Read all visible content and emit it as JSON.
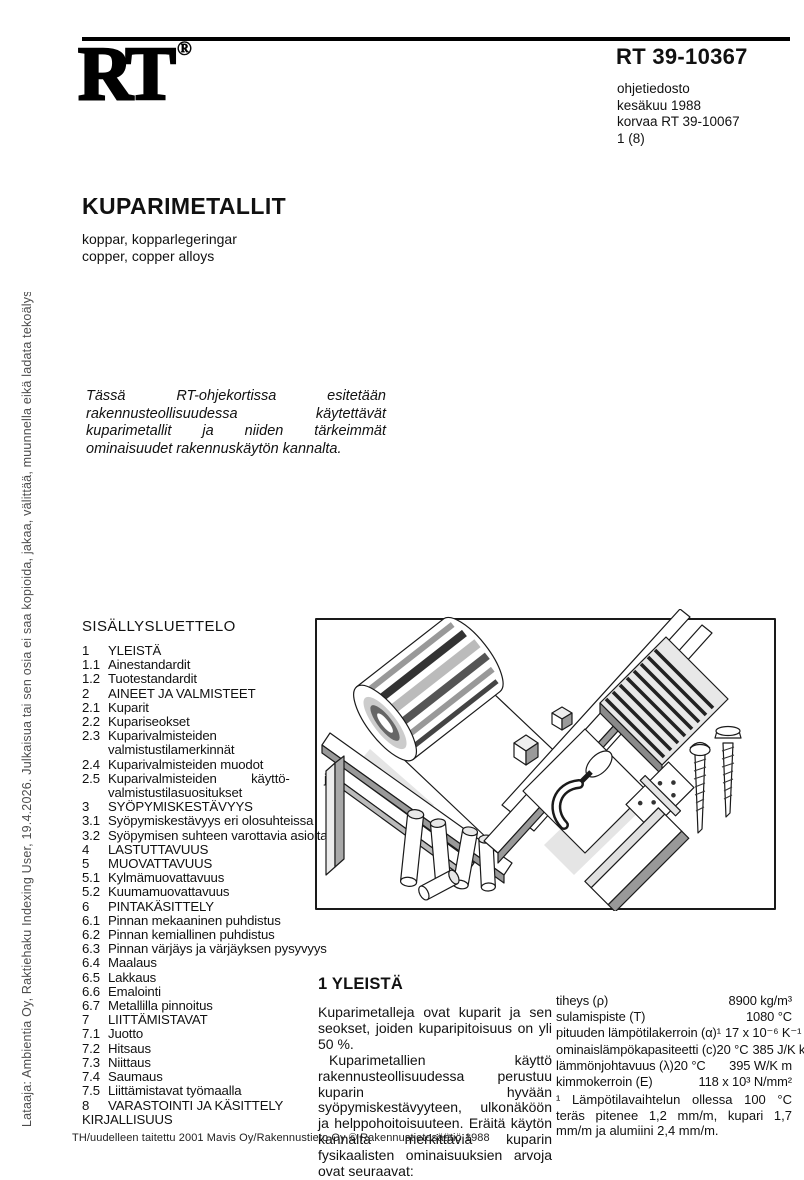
{
  "logo": {
    "text": "RT",
    "registered": "®"
  },
  "header": {
    "code": "RT 39-10367",
    "meta_lines": [
      "ohjetiedosto",
      "kesäkuu 1988",
      "korvaa RT 39-10067",
      "1 (8)"
    ]
  },
  "sidebar": {
    "text": "Lataaja: Ambientia Oy, Raktiehaku Indexing User, 19.4.2026. Julkaisua tai sen osia ei saa kopioida, jakaa, välittää, muunnella eikä ladata tekoälysovelluksiin."
  },
  "title": {
    "main": "KUPARIMETALLIT",
    "subtitle_sv": "koppar, kopparlegeringar",
    "subtitle_en": "copper, copper alloys"
  },
  "intro": {
    "text": "Tässä RT-ohjekortissa esitetään rakennusteollisuudessa käytettävät kuparimetallit ja niiden tärkeimmät ominaisuudet rakennuskäytön kannalta."
  },
  "toc": {
    "heading": "SISÄLLYSLUETTELO",
    "items": [
      {
        "num": "1",
        "label": "YLEISTÄ"
      },
      {
        "num": "1.1",
        "label": "Ainestandardit"
      },
      {
        "num": "1.2",
        "label": "Tuotestandardit"
      },
      {
        "num": "2",
        "label": "AINEET JA VALMISTEET"
      },
      {
        "num": "2.1",
        "label": "Kuparit"
      },
      {
        "num": "2.2",
        "label": "Kupariseokset"
      },
      {
        "num": "2.3",
        "label": "Kuparivalmisteiden valmistustilamerkinnät"
      },
      {
        "num": "2.4",
        "label": "Kuparivalmisteiden muodot"
      },
      {
        "num": "2.5",
        "label": "Kuparivalmisteiden käyttö- ja valmistustilasuositukset"
      },
      {
        "num": "3",
        "label": "SYÖPYMISKESTÄVYYS"
      },
      {
        "num": "3.1",
        "label": "Syöpymiskestävyys eri olosuhteissa"
      },
      {
        "num": "3.2",
        "label": "Syöpymisen suhteen varottavia asioita"
      },
      {
        "num": "4",
        "label": "LASTUTTAVUUS"
      },
      {
        "num": "5",
        "label": "MUOVATTAVUUS"
      },
      {
        "num": "5.1",
        "label": "Kylmämuovattavuus"
      },
      {
        "num": "5.2",
        "label": "Kuumamuovattavuus"
      },
      {
        "num": "6",
        "label": "PINTAKÄSITTELY"
      },
      {
        "num": "6.1",
        "label": "Pinnan mekaaninen puhdistus"
      },
      {
        "num": "6.2",
        "label": "Pinnan kemiallinen puhdistus"
      },
      {
        "num": "6.3",
        "label": "Pinnan värjäys ja värjäyksen pysyvyys"
      },
      {
        "num": "6.4",
        "label": "Maalaus"
      },
      {
        "num": "6.5",
        "label": "Lakkaus"
      },
      {
        "num": "6.6",
        "label": "Emalointi"
      },
      {
        "num": "6.7",
        "label": "Metallilla pinnoitus"
      },
      {
        "num": "7",
        "label": "LIITTÄMISTAVAT"
      },
      {
        "num": "7.1",
        "label": "Juotto"
      },
      {
        "num": "7.2",
        "label": "Hitsaus"
      },
      {
        "num": "7.3",
        "label": "Niittaus"
      },
      {
        "num": "7.4",
        "label": "Saumaus"
      },
      {
        "num": "7.5",
        "label": "Liittämistavat työmaalla"
      },
      {
        "num": "8",
        "label": "VARASTOINTI JA KÄSITTELY"
      },
      {
        "num": "KIRJALLISUUS",
        "label": ""
      }
    ]
  },
  "section": {
    "heading": "1 YLEISTÄ",
    "paragraphs": [
      "Kuparimetalleja ovat kuparit ja sen seokset, joiden kuparipitoisuus on yli 50 %.",
      "Kuparimetallien käyttö rakennusteollisuudessa perustuu kuparin hyvään syöpymiskestävyyteen, ulkonäköön ja helppohoitoisuuteen. Eräitä käytön kannalta merkittäviä kuparin fysikaalisten ominaisuuksien arvoja ovat seuraavat:"
    ]
  },
  "properties": {
    "rows": [
      {
        "label": "tiheys (ρ)",
        "value": "8900 kg/m³"
      },
      {
        "label": "sulamispiste (T)",
        "value": "1080 °C"
      },
      {
        "label": "pituuden lämpötilakerroin (α)¹",
        "value": "17 x 10⁻⁶ K⁻¹"
      },
      {
        "label": "ominaislämpökapasiteetti (c)20 °C",
        "value": "385 J/K kg"
      },
      {
        "label": "lämmönjohtavuus (λ)20 °C",
        "value": "395 W/K m"
      },
      {
        "label": "kimmokerroin (E)",
        "value": "118 x 10³ N/mm²"
      }
    ],
    "footnote": "¹ Lämpötilavaihtelun ollessa 100 °C teräs pitenee 1,2 mm/m, kupari 1,7 mm/m ja alumiini 2,4 mm/m."
  },
  "footer": {
    "text": "TH/uudelleen taitettu 2001 Mavis Oy/Rakennustieto Oy © Rakennustietosäätiö 1988"
  }
}
